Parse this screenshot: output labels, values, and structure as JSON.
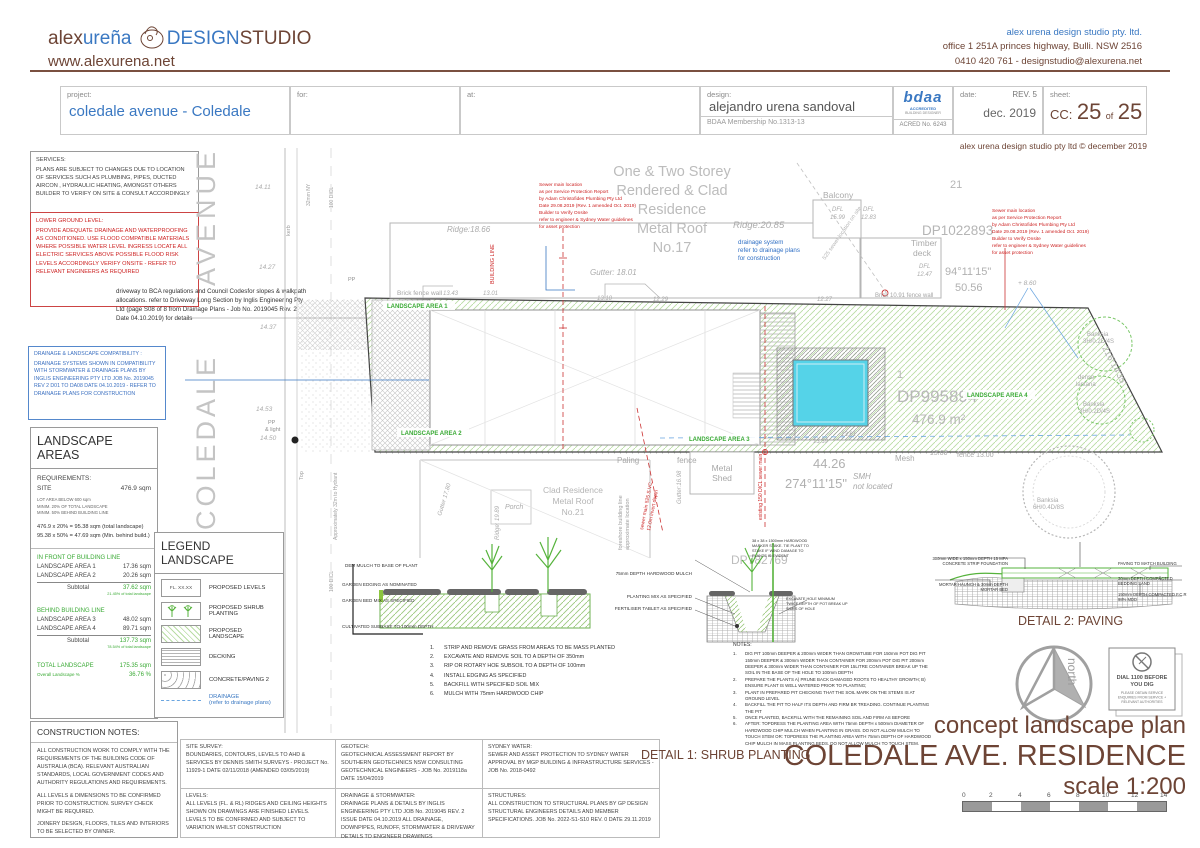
{
  "header": {
    "logo_alex": "alex",
    "logo_urena": "ureña",
    "logo_design": "DESIGN",
    "logo_studio": "STUDIO",
    "website": "www.alexurena.net",
    "company": "alex urena design studio pty. ltd.",
    "address": "office 1 251A princes highway, Bulli. NSW 2516",
    "contact": "0410 420 761  -  designstudio@alexurena.net"
  },
  "titleblock": {
    "project_label": "project:",
    "project": "coledale avenue - Coledale",
    "for_label": "for:",
    "at_label": "at:",
    "design_label": "design:",
    "designer": "alejandro urena sandoval",
    "membership": "BDAA Membership No.1313-13",
    "bdaa": "bdaa",
    "bdaa_acc": "ACCREDITED",
    "bdaa_bld": "BUILDING DESIGNER",
    "acred": "ACRED No. 6243",
    "date_label": "date:",
    "rev": "REV. 5",
    "date": "dec. 2019",
    "sheet_label": "sheet:",
    "sheet_cc": "CC:",
    "sheet_num": "25",
    "sheet_of": "of",
    "sheet_total": "25",
    "copyright": "alex urena design studio pty ltd © december 2019"
  },
  "side_notes": {
    "services_title": "SERVICES:",
    "services_body": "PLANS ARE SUBJECT TO CHANGES DUE TO LOCATION OF SERVICES SUCH AS PLUMBING, PIPES, DUCTED AIRCON , HYDRAULIC HEATING, AMONGST OTHERS BUILDER TO VERIFY ON SITE & CONSULT ACCORDINGLY",
    "lower_title": "LOWER GROUND LEVEL:",
    "lower_body": "PROVIDE ADEQUATE DRAINAGE AND WATERPROOFING AS CONDITIONED. USE FLOOD COMPATIBLE MATERIALS WHERE POSSIBLE WATER LEVEL INGRESS LOCATE ALL ELECTRIC SERVICES ABOVE POSSIBLE FLOOD RISK LEVELS ACCORDINGLY VERIFY ONSITE - REFER TO RELEVANT ENGINEERS AS REQUIRED",
    "driveway": "driveway to BCA regulations and Council Codesfor slopes & walkpath allocations. refer to Driveway Long Section by Inglis Engineering Pty Ltd (page S08 of 8 from Drainage Plans - Job No. 2019045 Rev. 2 Date 04.10.2019) for details",
    "drainage_title": "DRAINAGE & LANDSCAPE COMPATIBILITY :",
    "drainage_body": "DRAINAGE SYSTEMS SHOWN IN COMPATIBILITY WITH STORMWATER & DRAINAGE PLANS BY INGLIS ENGINEERING PTY LTD  JOB No. 2019045 REV 2 D01 TO DA08  DATE 04.10.2019 - REFER TO DRAINAGE PLANS FOR CONSTRUCTION"
  },
  "landscape_areas": {
    "title": "LANDSCAPE AREAS",
    "req_label": "REQUIREMENTS:",
    "site_label": "SITE",
    "site_value": "476.9  sqm",
    "lot_note1": "LOT AREA BELOW 600 sqm",
    "lot_note2": "MINIM. 20% OF TOTAL LANDSCAPE",
    "lot_note3": "MINIM. 50% BEHIND BUILDING LINE",
    "calc1": "476.9 x 20% = 95.38 sqm (total landscape)",
    "calc2": "95.38 x 50% = 47.69 sqm (Min. behind build.)",
    "front_header": "IN FRONT OF BUILDING LINE",
    "row1_label": "LANDSCAPE AREA 1",
    "row1_value": "17.36 sqm",
    "row2_label": "LANDSCAPE AREA 2",
    "row2_value": "20.26 sqm",
    "subtotal_label": "Subtotal",
    "front_subtotal": "37.62 sqm",
    "front_pct": "21.45% of total landscape",
    "behind_header": "BEHIND BUILDING LINE",
    "row3_label": "LANDSCAPE AREA 3",
    "row3_value": "48.02 sqm",
    "row4_label": "LANDSCAPE AREA 4",
    "row4_value": "89.71 sqm",
    "behind_subtotal": "137.73 sqm",
    "behind_pct": "78.54% of total landscape",
    "total_label": "TOTAL LANDSCAPE",
    "total_value": "175.35  sqm",
    "overall_label": "Overall Landscape %",
    "overall_value": "36.76 %"
  },
  "legend": {
    "title": "LEGEND  LANDSCAPE",
    "item1": "PROPOSED LEVELS",
    "item1_swatch": "FL. XX.XX",
    "item2": "PROPOSED SHRUB PLANTING",
    "item3": "PROPOSED LANDSCAPE",
    "item4": "DECKING",
    "item5": "CONCRETE/PAVING 2",
    "item6": "DRAINAGE",
    "item6_sub": "(refer to drainage plans)"
  },
  "construction_notes": {
    "title": "CONSTRUCTION NOTES:",
    "p1": "ALL CONSTRUCTION WORK TO COMPLY  WITH THE REQUIREMENTS OF THE BUILDING CODE OF AUSTRALIA (BCA). RELEVANT AUSTRALIAN STANDARDS, LOCAL GOVERNMENT CODES AND AUTHORITY REGULATIONS AND REQUIREMENTS.",
    "p2": "ALL LEVELS & DIMENSIONS TO BE CONFIRMED PRIOR TO CONSTRUCTION. SURVEY CHECK MIGHT BE REQUIRED.",
    "p3": "JOINERY DESIGN, FLOORS, TILES AND INTERIORS TO BE SELECTED BY OWNER."
  },
  "bottom_notes": {
    "site_survey_title": "SITE SURVEY:",
    "site_survey": "BOUNDARIES, CONTOURS, LEVELS TO AHD & SERVICES BY DENNIS SMITH SURVEYS - PROJECT No. 11929-1 DATE 02/11/2018 (AMENDED 03/05/2019)",
    "levels_title": "LEVELS:",
    "levels": "ALL LEVELS (FL. & RL) RIDGES AND CEILING HEIGHTS SHOWN ON DRAWINGS ARE FINISHED LEVELS. LEVELS TO BE CONFIRMED  AND SUBJECT TO VARIATION WHILST CONSTRUCTION",
    "geotech_title": "GEOTECH:",
    "geotech": "GEOTECHNICAL ASSESSMENT REPORT BY SOUTHERN GEOTECHNICS NSW CONSULTING GEOTECHNICAL ENGINEERS - JOB No. 2019118a  DATE 15/04/2019",
    "stormwater_title": "DRAINAGE & STORMWATER:",
    "stormwater": "DRAINAGE PLANS & DETAILS BY INGLIS ENGINEERING PTY LTD  JOB No. 2019045 REV. 2 ISSUE DATE 04.10.2019 ALL DRAINAGE, DOWNPIPES, RUNOFF, STORMWATER & DRIVEWAY DETAILS TO ENGINEER DRAWINGS",
    "sydney_water_title": "SYDNEY WATER:",
    "sydney_water": "SEWER AND ASSET PROTECTION TO SYDNEY WATER APPROVAL BY MGP BUILDING & INFRASTRUCTURE SERVICES - JOB No. 2018-0492",
    "structures_title": "STRUCTURES:",
    "structures": "ALL CONSTRUCTION TO STRUCTURAL PLANS BY GP DESIGN STRUCTURAL ENGINEERS DETAILS AND MEMBER SPECIFICATIONS. JOB No. 2022-S1-S10 REV. 0 DATE 29.11.2019"
  },
  "plan": {
    "street_top": "AVENUE",
    "street_bottom": "COLEDALE",
    "res17": [
      "One & Two Storey",
      "Rendered & Clad",
      "Residence",
      "Metal Roof",
      "No.17"
    ],
    "ridge_1866": "Ridge:18.66",
    "ridge_2085": "Ridge:20.85",
    "gutter_1801": "Gutter: 18.01",
    "balcony": "Balcony",
    "dfl_a": "DFL",
    "dfl_a_val": "15.99",
    "dfl_b": "DFL",
    "dfl_b_val": "12.83",
    "timber_deck": [
      "Timber",
      "deck"
    ],
    "dfl_c": "DFL",
    "dfl_c_val": "12.47",
    "lot21": "21",
    "dp1022893": "DP1022893",
    "dim_top_bearing": "94°11'15\"",
    "dim_top_len": "50.56",
    "brick_fence_left": "Brick fence wall",
    "brick_1091": "Brick 10.91 fence  wall",
    "dim_right_bearing": "216°14'35\"",
    "sewer_note": [
      "Sewer main location",
      "as per Service Protection Report",
      "by Adam Christofides Plumbing Pty Ltd",
      "Date 29.08.2019 (Rev. 1 amended Oct. 2019)",
      "Builder to Verify Onsite",
      "refer to engineer & Sydney Water guidelines",
      "for asset protection"
    ],
    "drainage_sys": [
      "drainage system",
      "refer to drainage plans",
      "for construction"
    ],
    "building_line": "BUILDING LINE",
    "sewer_diag": "525 sewer location on site",
    "dp995894": "DP995894",
    "site_area": "476.9 m²",
    "lot1": "1",
    "la1": "LANDSCAPE AREA 1",
    "la2": "LANDSCAPE AREA 2",
    "la3": "LANDSCAPE AREA 3",
    "la4": "LANDSCAPE AREA 4",
    "banksia_a": [
      "Banksia",
      "3H/0.2D/4S"
    ],
    "lantana": [
      "dense",
      "lantana"
    ],
    "banksia_b": [
      "Banksia",
      "3H/0.2D/4S"
    ],
    "banksia_c": [
      "Banksia",
      "6H/0.4D/8S"
    ],
    "paling": "Paling",
    "fence_word": "fence",
    "dim_bottom_len": "44.26",
    "dim_bottom_bearing": "274°11'15\"",
    "mesh": "Mesh",
    "mesh_len": "13.06",
    "fence_1300": "fence 13.00",
    "smh": [
      "SMH",
      "not located"
    ],
    "metal_shed": [
      "Metal",
      "Shed"
    ],
    "clad21": [
      "Clad Residence",
      "Metal Roof",
      "No.21"
    ],
    "porch": "Porch",
    "ridge_1989": "Ridge: 19.89",
    "gutter_1780": "Gutter 17.80",
    "gutter_1698": "Gutter:16.98",
    "dp782769": "DP782769",
    "foreshore": [
      "foreshore building line",
      "approximate location"
    ],
    "sewer_v": "existing 150 DICL sewer main",
    "sewer_d": [
      "sewer main 525 S.VC",
      "12.0m invert depth"
    ],
    "pp_light": [
      "PP",
      "& light"
    ],
    "pp": "PP",
    "kerb": "kerb",
    "top_a": "Top",
    "ny32": "32mm NY",
    "dicl100_a": "100 DICL",
    "dicl100_b": "100 DICL",
    "hydrant": "Approximately 32m to Hydrant",
    "lv_1411": "14.11",
    "lv_1427": "14.27",
    "lv_1437": "14.37",
    "lv_1453": "14.53",
    "lv_1450": "14.50",
    "lv_1343": "13.43",
    "lv_1301": "13.01",
    "lv_1310": "13.10",
    "lv_1229": "12.29",
    "lv_1227": "12.27",
    "lv_860": "+ 8.60",
    "lv_1361": "13.61",
    "lv_1339": "13.39"
  },
  "detail1": {
    "title": "DETAIL 1: SHRUB PLANTING",
    "left_labels": [
      "DEM MULCH TO BASE OF PLANT",
      "GARDEN EDGING AS NOMINATED",
      "GARDEN BED MIX AS SPECIFIED",
      "CULTIVATED SUBBASE TO 100mm DEPTH"
    ],
    "right_labels": [
      "75mm DEPTH HARDWOOD MULCH",
      "PLANTING MIX AS SPECIFIED",
      "FERTILISER TABLET AS SPECIFIED"
    ],
    "stake_label": "38 x 38 x 1500mm HARDWOOD MARKER STAKE. TIE PLANT TO STAKE IF WIND DAMAGE TO PLANTS IS EVIDENT",
    "excavate_label": "EXCAVATE HOLE MINIMUM TWICE DEPTH OF POT BREAK UP SIDES OF HOLE",
    "steps": [
      "STRIP AND REMOVE GRASS FROM AREAS TO BE MASS PLANTED",
      "EXCAVATE AND REMOVE SOIL TO A DEPTH OF 350mm",
      "RIP OR ROTARY HOE SUBSOIL TO A DEPTH OF 100mm",
      "INSTALL EDGING AS SPECIFIED",
      "BACKFILL WITH SPECIFIED SOIL MIX",
      "MULCH WITH 75mm HARDWOOD CHIP"
    ],
    "notes_title": "NOTES:",
    "notes": [
      "DIG PIT 100mm DEEPER & 200mm WIDER THAN GROWTUBE FOR 150mm POT   DIG PIT 150mm DEEPER & 300mm WIDER THAN CONTAINER FOR 200mm POT   DIG PIT 200mm DEEPER & 300mm WIDER THAN CONTAINER FOR 15LITRE CONTAINER   BREAK UP THE SOIL IN THE BASE OF THE HOLE TO 100mm DEPTH",
      "PREPARE THE PLANTS A) PRUNE BACK DAMAGED ROOTS TO HEALTHY GROWTH;  B) ENSURE PLANT IS WELL WATERED PRIOR TO PLANTING;",
      "PLANT IN PREPARED PIT CHECKING THAT THE SOIL MARK ON THE STEMS IS AT GROUND LEVEL",
      "BACKFILL THE PIT TO HALF ITS DEPTH AND FIRM BR TREADING. CONTINUE PLANTING THE PIT",
      "ONCE PLANTED, BACKFILL WITH THE REMAINING SOIL AND FIRM AS BEFORE",
      "AFTER: TOPDRESS THE PLANTING AREA WITH 75mm DEPTH x 500mm DIAMETER OF HARDWOOD CHIP MULCH WHEN PLANTING IN GRASS. DO NOT ALLOW MULCH TO TOUCH STEM OR: TOPDRESS THE PLANTING AREA WITH 75mm DEPTH OF HARDWOOD CHIP MULCH IN MASS PLANTING BEDS. DO NOT ALLOW MULCH TO TOUCH STEM."
    ]
  },
  "detail2": {
    "title": "DETAIL 2: PAVING",
    "left_labels": [
      "300mm WIDE x 150mm DEPTH 15 MPA CONCRETE STRIP FOUNDATION",
      "MORTAR HAUNCH & 30mm DEPTH MORTAR BED"
    ],
    "right_labels": [
      "PAVING TO MATCH BUILDING",
      "30mm DEPTH COMPACTED BEDDING SAND",
      "150mm DEPTH COMPACTED F.C.R 98% MDD"
    ]
  },
  "footer": {
    "north": "north",
    "dial1": "DIAL 1100 BEFORE",
    "dial2": "YOU DIG",
    "dial3": "PLEASE OBTAIN SERVICE",
    "dial4": "ENQUIRIES FROM SERVICE +",
    "dial5": "RELEVANT AUTHORITIES",
    "title_line1": "concept landscape plan",
    "title_line2": "COLEDALE AVE. RESIDENCE",
    "title_line3": "scale 1:200",
    "scale_ticks": [
      "0",
      "2",
      "4",
      "6",
      "8",
      "10",
      "12",
      "14"
    ]
  },
  "colors": {
    "brown": "#6d4435",
    "blue": "#3a78c2",
    "red": "#cc2222",
    "green": "#3aaa35",
    "grey": "#a9a9a9",
    "pool": "#55d3e8"
  }
}
